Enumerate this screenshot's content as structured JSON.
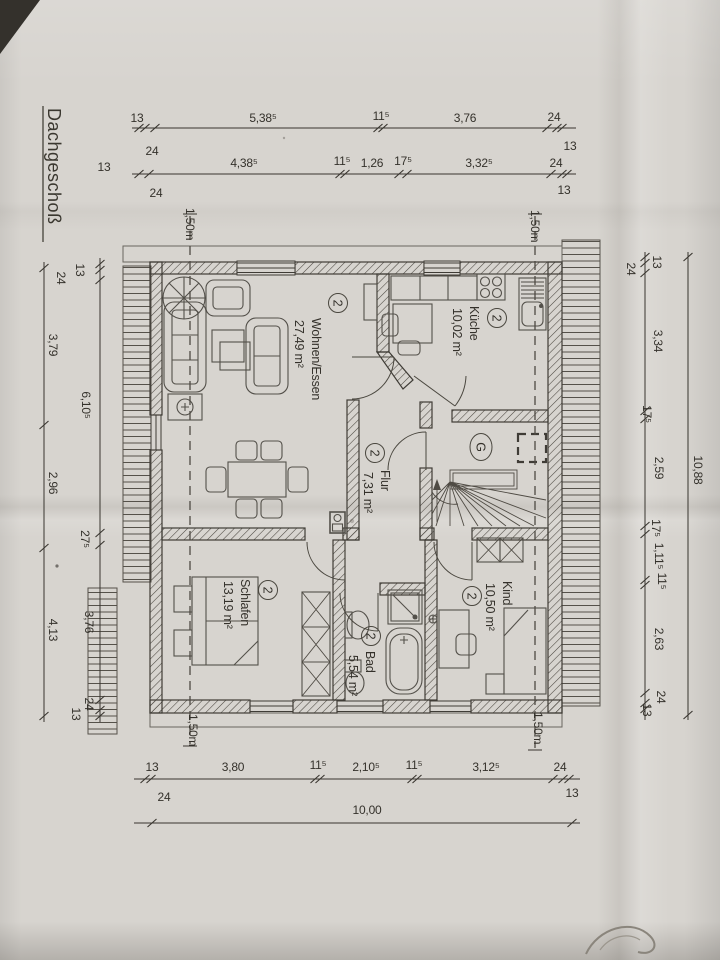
{
  "colors": {
    "paper": "#d7d4cf",
    "ink": "#38352f"
  },
  "title": {
    "floor_label": "Dachgeschoß"
  },
  "height_marks": {
    "label": "1,50m"
  },
  "stairs": {
    "label": "G"
  },
  "rooms": {
    "wohnen": {
      "unit": "2",
      "name": "Wohnen/Essen",
      "area": "27,49 m²"
    },
    "kueche": {
      "unit": "2",
      "name": "Küche",
      "area": "10,02 m²"
    },
    "flur": {
      "unit": "2",
      "name": "Flur",
      "area": "7,31 m²"
    },
    "schlafen": {
      "unit": "2",
      "name": "Schlafen",
      "area": "13,19 m²"
    },
    "bad": {
      "unit": "2",
      "name": "Bad",
      "area": "5,54 m²"
    },
    "kind": {
      "unit": "2",
      "name": "Kind",
      "area": "10,50 m²"
    }
  },
  "dims": {
    "top_row1": {
      "a": "13",
      "b": "5,38⁵",
      "c": "11⁵",
      "d": "3,76",
      "e": "24",
      "below_left": "24",
      "right_below": "13"
    },
    "top_row2": {
      "far_left": "13",
      "a": "4,38⁵",
      "b": "11⁵",
      "c": "1,26",
      "d": "17⁵",
      "e": "3,32⁵",
      "f": "24",
      "below_left": "24",
      "below_right": "13"
    },
    "left_outer": {
      "a": "3,79",
      "b": "2,96",
      "c": "4,13"
    },
    "left_inner": {
      "t1": "13",
      "t2": "24",
      "a": "6,10⁵",
      "b": "27⁵",
      "c": "3,76",
      "b1": "24",
      "b2": "13"
    },
    "right_inner": {
      "t1": "13",
      "t2": "24",
      "a": "3,34",
      "b": "17⁵",
      "c": "2,59",
      "d": "17⁵",
      "e": "1,11⁵",
      "f": "11⁵",
      "g": "2,63",
      "b1": "24",
      "b2": "13"
    },
    "right_outer": {
      "total": "10,88"
    },
    "bottom_row1": {
      "left": "13",
      "a": "3,80",
      "b": "11⁵",
      "c": "2,10⁵",
      "d": "11⁵",
      "e": "3,12⁵",
      "f": "24",
      "below_left": "24",
      "below_right": "13"
    },
    "bottom_row2": {
      "total": "10,00"
    }
  }
}
